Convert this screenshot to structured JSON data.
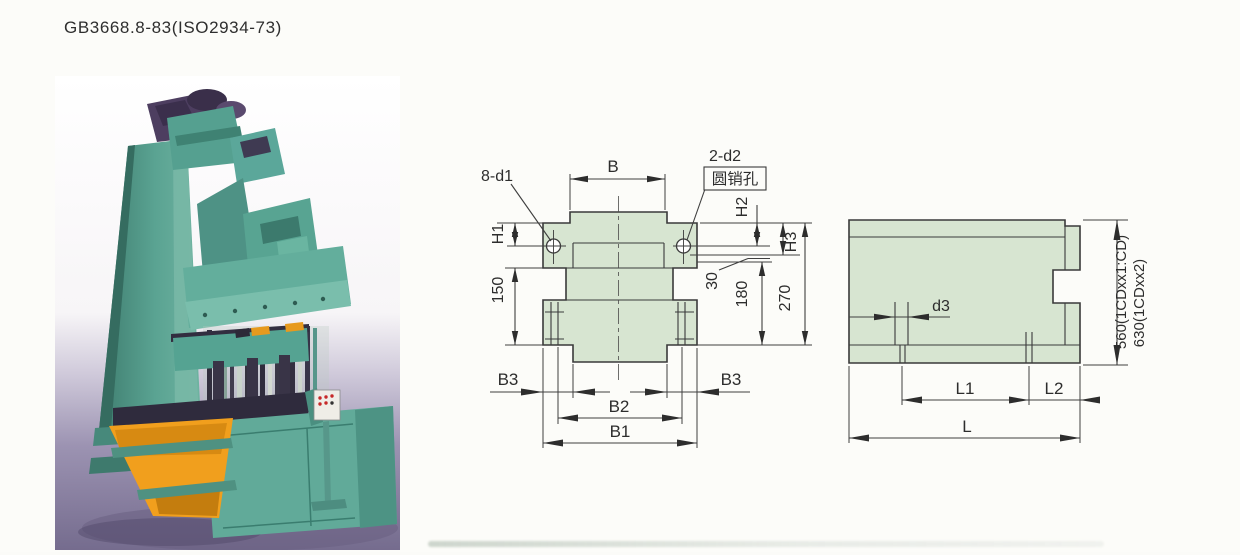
{
  "page": {
    "title": "GB3668.8-83(ISO2934-73)"
  },
  "photo": {
    "description": "Color photograph of a vertical green press / moulding machine with an orange discharge chute and a small control panel, standing on a purple-grey floor",
    "colors": {
      "machine_green": "#5aa392",
      "machine_green_dark": "#3d8374",
      "machine_green_light": "#7fbfae",
      "chute_orange": "#f19f1d",
      "floor_purple": "#8d84a4",
      "head_purple": "#4d3e60",
      "dark_metal": "#332f42"
    }
  },
  "drawing": {
    "fill_color": "#d7e5d1",
    "line_color": "#3a3a3a",
    "front_view": {
      "labels": {
        "b": "B",
        "label_8_d1": "8-d1",
        "label_2_d2": "2-d2",
        "pin_hole_note": "圆销孔",
        "h1": "H1",
        "h2": "H2",
        "h3": "H3",
        "d150": "150",
        "d30": "30",
        "d180": "180",
        "d270": "270",
        "b3_left": "B3",
        "b3_right": "B3",
        "b2": "B2",
        "b1": "B1"
      }
    },
    "side_view": {
      "labels": {
        "d3": "d3",
        "l1": "L1",
        "l2": "L2",
        "l": "L",
        "height_model_1": "560(1CDxx1:CD)",
        "height_model_2": "630(1CDxx2)"
      }
    }
  }
}
